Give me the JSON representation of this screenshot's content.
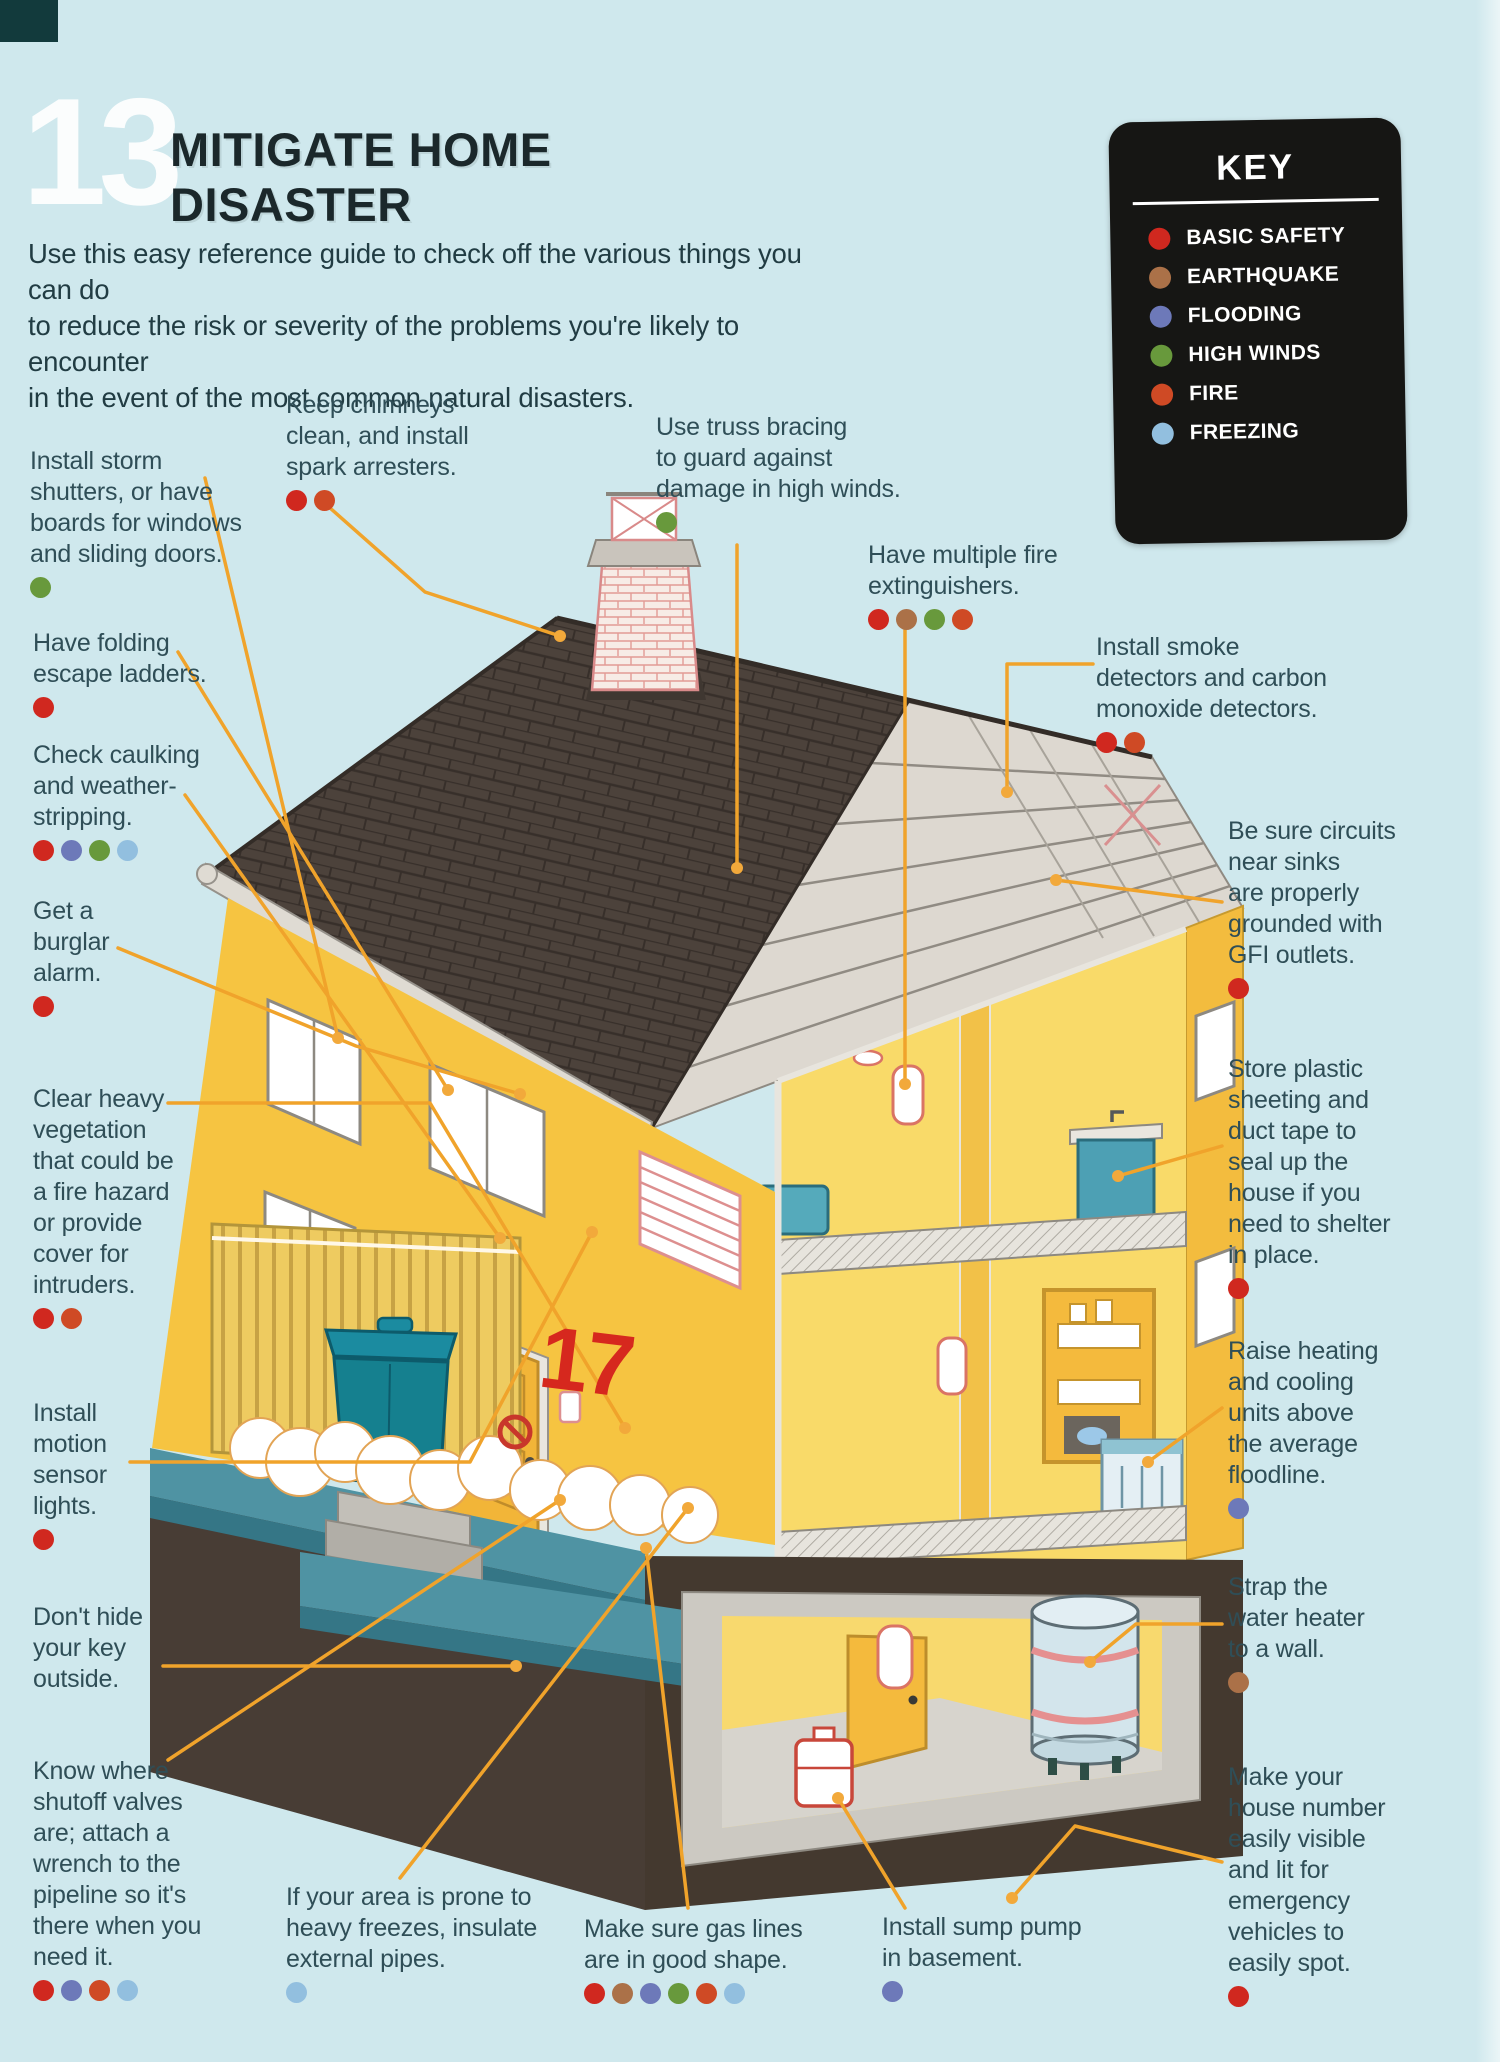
{
  "page": {
    "stencil_number": "13",
    "title_line1": "MITIGATE HOME",
    "title_line2": "DISASTER",
    "intro": "Use this easy reference guide to check off the various things you can do\nto reduce the risk or severity of the problems you're likely to encounter\nin the event of the most common natural disasters.",
    "house_number": "17",
    "background_color": "#cfe8ed",
    "leader_line_color": "#f0a32b"
  },
  "key": {
    "title": "KEY",
    "items": [
      {
        "id": "basic",
        "label": "BASIC SAFETY",
        "color": "#d0281f"
      },
      {
        "id": "earthquake",
        "label": "EARTHQUAKE",
        "color": "#ab7148"
      },
      {
        "id": "flooding",
        "label": "FLOODING",
        "color": "#6d79b9"
      },
      {
        "id": "high_winds",
        "label": "HIGH WINDS",
        "color": "#68993c"
      },
      {
        "id": "fire",
        "label": "FIRE",
        "color": "#cf4a25"
      },
      {
        "id": "freezing",
        "label": "FREEZING",
        "color": "#92bfdf"
      }
    ]
  },
  "callouts": {
    "storm_shutters": {
      "text": "Install storm\nshutters, or have\nboards for windows\nand sliding doors.",
      "dots": [
        "high_winds"
      ]
    },
    "chimneys": {
      "text": "Keep chimneys\nclean, and install\nspark arresters.",
      "dots": [
        "basic",
        "fire"
      ]
    },
    "truss_bracing": {
      "text": "Use truss bracing\nto guard against\ndamage in high winds.",
      "dots": [
        "high_winds"
      ]
    },
    "fire_extinguishers": {
      "text": "Have multiple fire\nextinguishers.",
      "dots": [
        "basic",
        "earthquake",
        "high_winds",
        "fire"
      ]
    },
    "smoke_detectors": {
      "text": "Install smoke\ndetectors and carbon\nmonoxide detectors.",
      "dots": [
        "basic",
        "fire"
      ]
    },
    "folding_ladders": {
      "text": "Have folding\nescape ladders.",
      "dots": [
        "basic"
      ]
    },
    "caulking": {
      "text": "Check caulking\nand weather-\nstripping.",
      "dots": [
        "basic",
        "flooding",
        "high_winds",
        "freezing"
      ]
    },
    "burglar_alarm": {
      "text": "Get a\nburglar\nalarm.",
      "dots": [
        "basic"
      ]
    },
    "gfi_outlets": {
      "text": "Be sure circuits\nnear sinks\nare properly\ngrounded with\nGFI outlets.",
      "dots": [
        "basic"
      ]
    },
    "plastic_sheeting": {
      "text": "Store plastic\nsheeting and\nduct tape to\nseal up the\nhouse if you\nneed to shelter\nin place.",
      "dots": [
        "basic"
      ]
    },
    "vegetation": {
      "text": "Clear heavy\nvegetation\nthat could be\na fire hazard\nor provide\ncover for\nintruders.",
      "dots": [
        "basic",
        "fire"
      ]
    },
    "heating_cooling": {
      "text": "Raise heating\nand cooling\nunits above\nthe average\nfloodline.",
      "dots": [
        "flooding"
      ]
    },
    "motion_lights": {
      "text": "Install\nmotion\nsensor\nlights.",
      "dots": [
        "basic"
      ]
    },
    "water_heater": {
      "text": "Strap the\nwater heater\nto a wall.",
      "dots": [
        "earthquake"
      ]
    },
    "key_outside": {
      "text": "Don't hide\nyour key\noutside.",
      "dots": []
    },
    "shutoff_valves": {
      "text": "Know where\nshutoff valves\nare; attach a\nwrench to the\npipeline so it's\nthere when you\nneed it.",
      "dots": [
        "basic",
        "flooding",
        "fire",
        "freezing"
      ]
    },
    "house_number_visible": {
      "text": "Make your\nhouse number\neasily visible\nand lit for\nemergency\nvehicles to\neasily spot.",
      "dots": [
        "basic"
      ]
    },
    "freezes_pipes": {
      "text": "If your area is prone to\nheavy freezes, insulate\nexternal pipes.",
      "dots": [
        "freezing"
      ]
    },
    "gas_lines": {
      "text": "Make sure gas lines\nare in good shape.",
      "dots": [
        "basic",
        "earthquake",
        "flooding",
        "high_winds",
        "fire",
        "freezing"
      ]
    },
    "sump_pump": {
      "text": "Install sump pump\nin basement.",
      "dots": [
        "flooding"
      ]
    }
  }
}
